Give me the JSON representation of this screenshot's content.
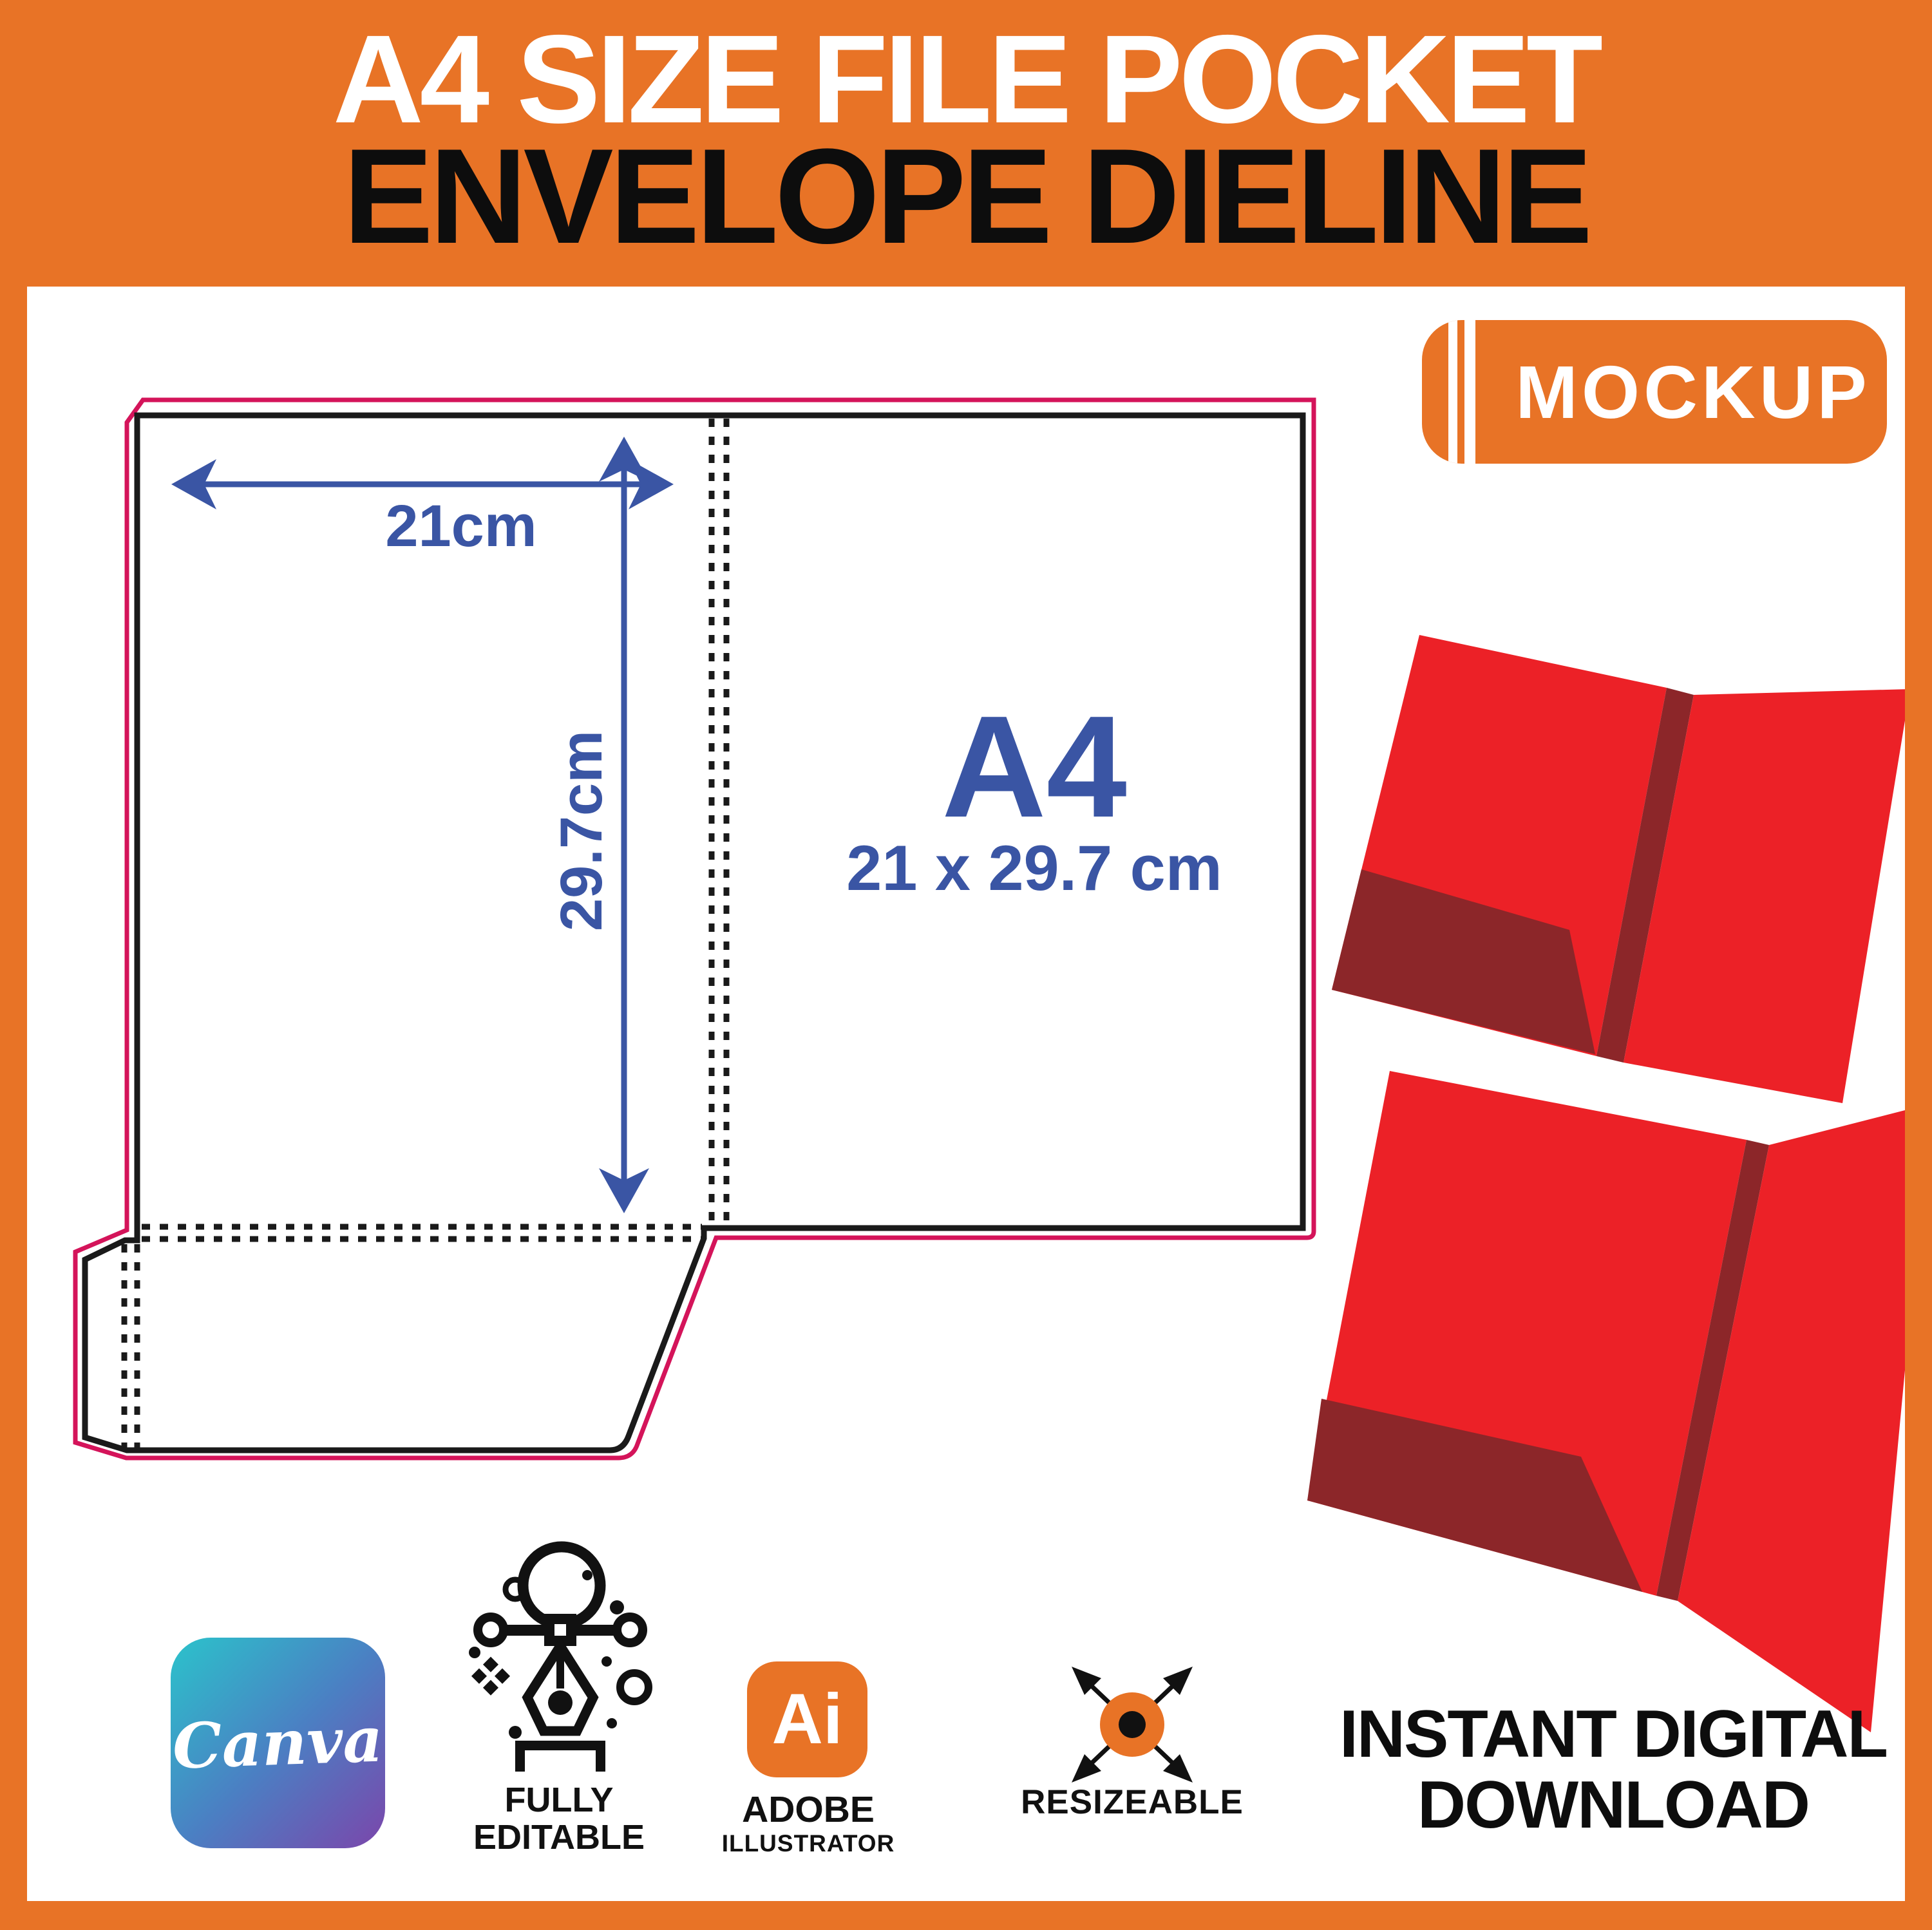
{
  "header": {
    "title_line1": "A4 SIZE FILE POCKET",
    "title_line2": "ENVELOPE DIELINE"
  },
  "badge": {
    "label": "MOCKUP"
  },
  "dieline": {
    "width_label": "21cm",
    "height_label": "29.7cm",
    "paper_size": "A4",
    "paper_dimensions": "21 x 29.7 cm",
    "cut_line_color": "#d4145a",
    "fold_line_color": "#1a1a1a",
    "dimension_color": "#3a55a4"
  },
  "mockup_folders": {
    "count": 2,
    "folder_color": "#ec2127",
    "pocket_shadow_color": "#8c2629"
  },
  "features": {
    "canva": {
      "label": "Canva",
      "icon": "canva-logo"
    },
    "editable": {
      "line1": "FULLY",
      "line2": "EDITABLE",
      "icon": "pen-tool-icon"
    },
    "adobe": {
      "icon_label": "Ai",
      "line1": "ADOBE",
      "line2": "ILLUSTRATOR",
      "icon": "adobe-illustrator-icon"
    },
    "resizeable": {
      "label": "RESIZEABLE",
      "icon": "resize-arrows-icon"
    },
    "download": {
      "line1": "INSTANT DIGITAL",
      "line2": "DOWNLOAD"
    }
  },
  "colors": {
    "orange": "#e87326",
    "white": "#ffffff",
    "black": "#111111"
  }
}
